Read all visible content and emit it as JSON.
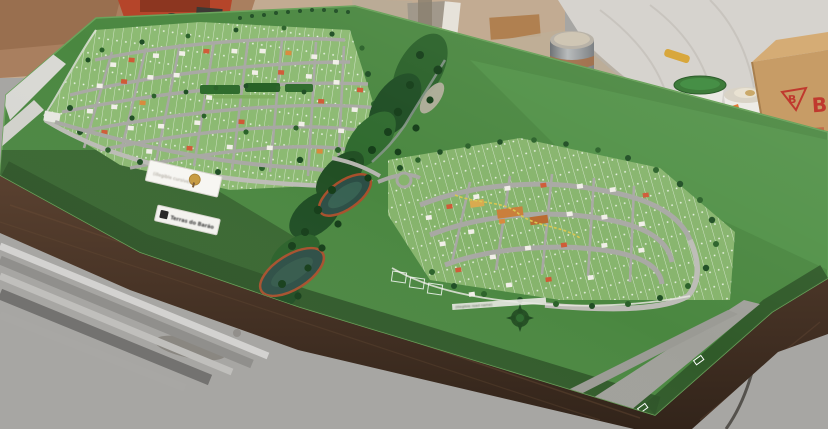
{
  "scene": {
    "type": "photograph",
    "subject": "Architectural scale model of a residential land development (two street grids separated by a wooded creek with ponds) on a dark wooden table in a workshop"
  },
  "model": {
    "sign_plaques": {
      "plaque_top": {
        "logo": "tree-emblem",
        "text": "(illegible cursive)"
      },
      "plaque_bottom": {
        "logo": "dark-square-logo",
        "text": "Terras do Barão"
      }
    },
    "road_name_strip": {
      "text": "(illegible road name)"
    },
    "compass_emblem": "dark green compass rose"
  },
  "background": {
    "cardboard_box": {
      "triangle_letter": "B",
      "side_letter": "B"
    },
    "objects": [
      "orange bench machine",
      "metal canister",
      "white plastic sheeting",
      "paint bucket with green lid",
      "second paint bucket",
      "dark bottle",
      "power cable on floor",
      "yellow tool"
    ]
  },
  "colors": {
    "floor": "#a7a6a3",
    "wall-beige": "#c2ab92",
    "wall-brown": "#a97f5f",
    "wall-deep": "#996f4f",
    "sheeting": "#d6d3ce",
    "box-tan": "#c79c66",
    "box-tan-top": "#d5ac75",
    "box-red": "#c0392e",
    "machine-orange": "#b5452a",
    "bucket-white": "#eae8e3",
    "lid-green": "#3d7b3a",
    "label-orange": "#e06b20",
    "board-green": "#4a8740",
    "board-green-light": "#529449",
    "board-green-dark": "#335f2c",
    "board-green-deep": "#2b5226",
    "lot-green": "#8cba72",
    "lot-green-r": "#86b46c",
    "street": "#a8a8a3",
    "street-light": "#bcbcb6",
    "sidewalk": "#e6e6df",
    "tree-dark": "#1e4d23",
    "tree-mid": "#2a6129",
    "tree-deep": "#143d18",
    "water": "#2c4e45",
    "water-bank": "#a8502c",
    "park-green": "#2e6b2c",
    "path-yellow": "#d9c750",
    "wood-dark": "#3a2a1d",
    "wood-mid": "#4a3526",
    "wood-light": "#6b4e38",
    "house-white": "#f1efe8",
    "house-red": "#cf5a36",
    "house-orange": "#d88a3c",
    "metal-light": "#d3d2d0",
    "metal-dark": "#737270",
    "cable": "#55524d",
    "tool-yellow": "#d8a73c"
  }
}
